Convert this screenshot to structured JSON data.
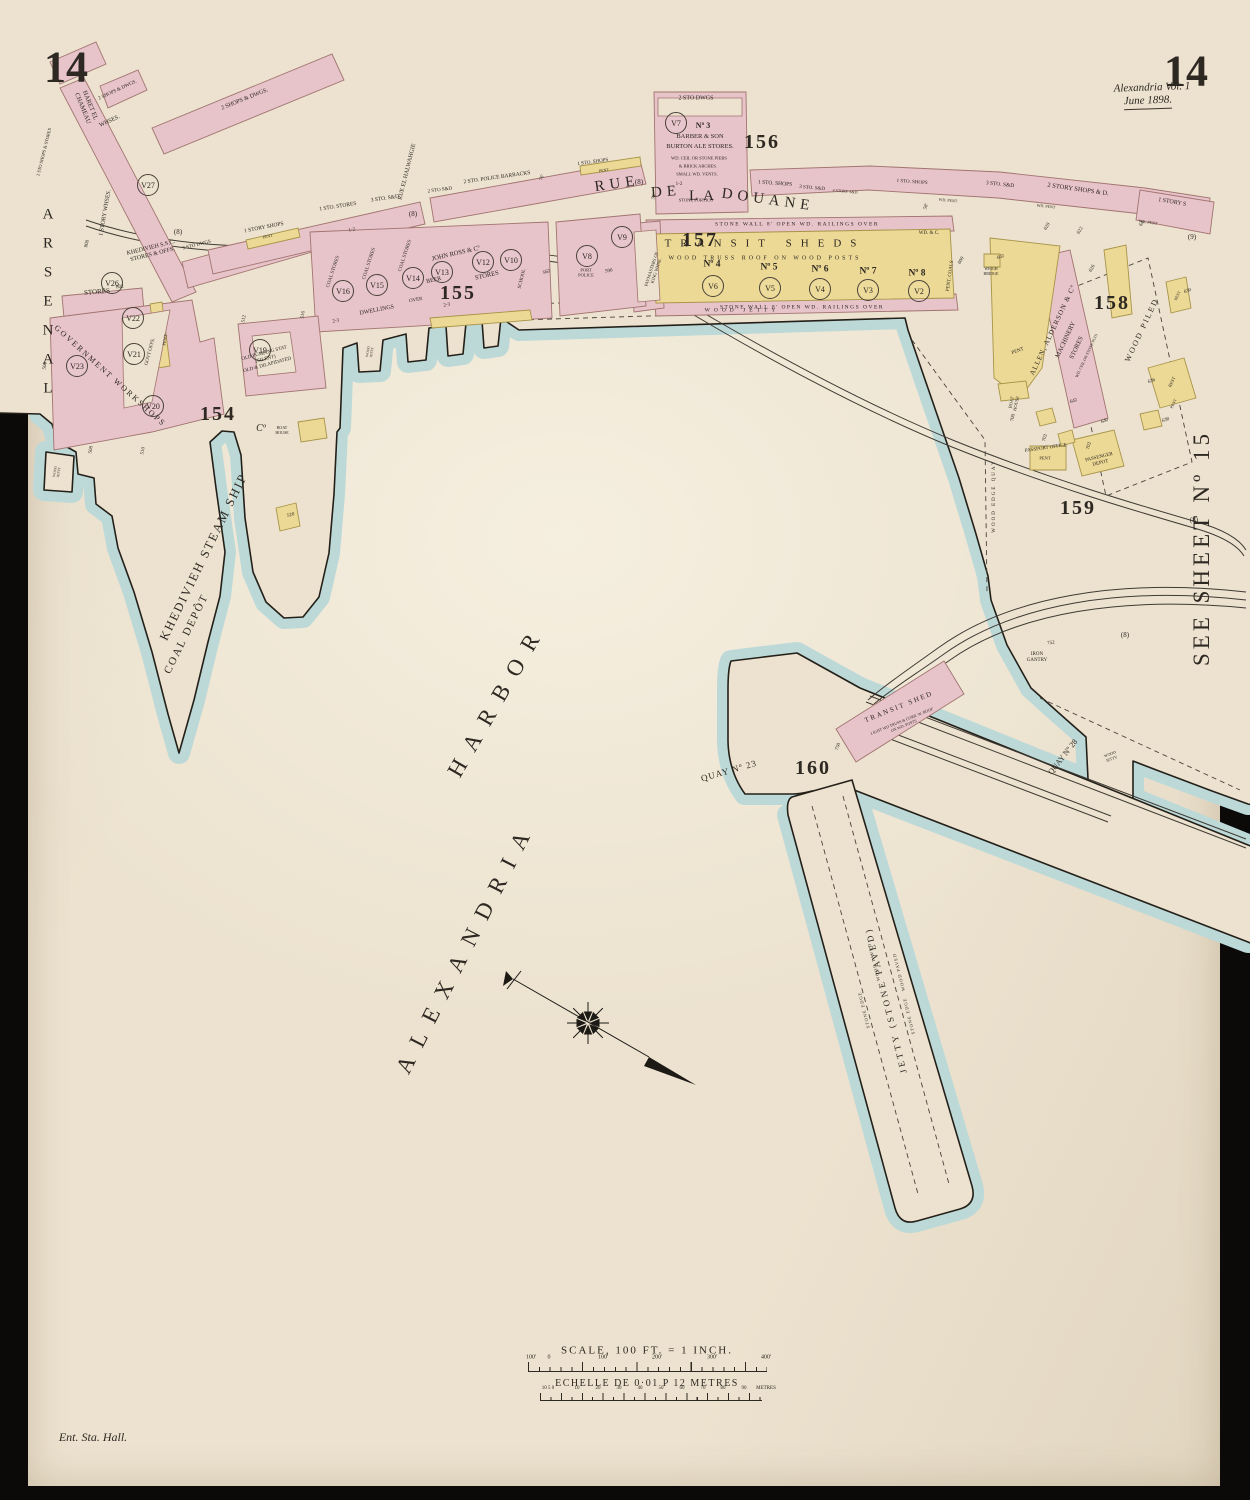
{
  "colors": {
    "paper": "#ece2cf",
    "water": "#bcd9d8",
    "building_pink": "#e7c3ca",
    "building_yellow": "#ecd995",
    "ink": "#2e2822",
    "frame": "#0b0a08"
  },
  "sheet": {
    "no_left": "14",
    "no_right": "14",
    "volume": "Alexandria Vol. 1",
    "date": "June 1898.",
    "see_sheet": "SEE SHEET Nº 15",
    "corner_note": "Ent. Sta. Hall."
  },
  "streets": {
    "rue": "RUE",
    "de": "DE",
    "la": "LA",
    "douane": "DOUANE",
    "haret": "HARET EL\nCHAMEAU",
    "halwahgie": "RUE EL HALWAHGIE",
    "arsenal": "ARSENAL"
  },
  "harbor": {
    "name1": "ALEXANDRIA",
    "name2": "HARBOR",
    "khedivieh": "KHEDIVIEH STEAM SHIP",
    "coal_depot": "COAL DEPÔT"
  },
  "blocks": {
    "b154": "154",
    "b155": "155",
    "b156": "156",
    "b157": "157",
    "b158": "158",
    "b159": "159",
    "b160": "160"
  },
  "v": {
    "v2": "V2",
    "v3": "V3",
    "v4": "V4",
    "v5": "V5",
    "v6": "V6",
    "v7": "V7",
    "v8": "V8",
    "v9": "V9",
    "v10": "V10",
    "v12": "V12",
    "v13": "V13",
    "v14": "V14",
    "v15": "V15",
    "v16": "V16",
    "v19": "V19",
    "v20": "V20",
    "v21": "V21",
    "v22": "V22",
    "v23": "V23",
    "v26": "V26",
    "v27": "V27"
  },
  "refs": {
    "r8": "(8)",
    "r9": "(9)"
  },
  "bldg": {
    "shops_dwgs": "2 SHOPS & DWGS.",
    "whses": "WHSES.",
    "story_whses": "1 STORY WHSES.",
    "sto_shops_stores": "2 STO SHOPS & STORES",
    "stores": "STORES",
    "khedivieh_ssc": "KHEDIVIEH S.S.C.\nSTORES & OFFS.",
    "sto_dwgs3": "3 STO DWGS",
    "story_shops": "1 STORY SHOPS",
    "sto_stores": "1 STO. STORES",
    "sto_sd3": "3 STO. S&D",
    "sto_sd2": "2 STO S&D",
    "police_barracks": "2 STO. POLICE BARRACKS",
    "sto_shops": "1 STO. SHOPS",
    "pent": "PENT",
    "sto_dwgs2": "2 STO DWGS",
    "no3": "Nº 3",
    "barber": "BARBER & SON",
    "burton": "BURTON ALE STORES.",
    "wd_ceil": "WD. CEIL OR STONE PIERS",
    "brick_arches": "& BRICK ARCHES.",
    "small_vents": "SMALL WD. VENTS.",
    "one_two": "1-2",
    "stone_portico": "STONE PORTICO",
    "sto_sd4": "4 STORY S&D",
    "story_shops_d2": "2 STORY SHOPS & D.",
    "story_s1": "1 STORY S",
    "wd_pent": "WD. PENT",
    "stone_wall": "STONE WALL 8' OPEN WD. RAILINGS OVER",
    "transit_sheds": "TRANSIT SHEDS",
    "wood_truss": "WOOD TRUSS ROOF ON WOOD POSTS",
    "shed4": "Nº 4",
    "shed5": "Nº 5",
    "shed6": "Nº 6",
    "shed7": "Nº 7",
    "shed8": "Nº 8",
    "wd_c": "WD. & C.",
    "pent_coals": "PENT. COALS",
    "paymasters": "PAYMASTERS OF\nKING WHSE.",
    "port_police": "PORT\nPOLICE",
    "gov_workshops": "GOVERNMENT WORKSHOPS",
    "govt_offs": "GOVT OFFS.",
    "old_pumping": "OLD PUMPING STAT\n(SILENT)\nOLD & DILAPIDATED",
    "co": "Cº",
    "boat_house": "BOAT\nHOUSE",
    "coal_stores": "COAL STORES",
    "john_ross": "JOHN ROSS & Cº",
    "beer": "BEER",
    "school": "SCHOOL",
    "dwellings": "DWELLINGS",
    "over": "OVER",
    "two_three": "2-3",
    "allen": "ALLEN, ALDERSON & Cº",
    "machinery": "MACHINERY",
    "wd_ceil2": "WD. CEIL OR STONE PLTS",
    "wood_piled": "WOOD PILED",
    "weigh_bridge": "WEIGH\nBRIDGE",
    "rest": "REST",
    "passport": "PASSPORT OFFICE",
    "passenger": "PASSENGER\nDEPOT",
    "wood_edge_quay": "WOOD EDGE QUAY",
    "iron_gantry": "IRON\nGANTRY",
    "transit_shed": "TRANSIT SHED",
    "light_truss": "LIGHT WD TRUSS & CORR. W. ROOF\nON WD. POSTS",
    "quay23": "QUAY Nº 23",
    "quay28": "QUAY Nº 28",
    "wood_jetty": "WOOD JETTY",
    "wood_jetty2": "WOOD\nJETTY",
    "jetty_main": "JETTY (STONE PAVED)",
    "stone_edge": "STONE EDGE",
    "wood_paved": "WOOD PAVED"
  },
  "nums": {
    "n58": "58'",
    "n64": "64'",
    "n76": "76'",
    "n500": "500",
    "n508": "508",
    "n510": "510",
    "n512": "512",
    "n516": "516",
    "n520": "520",
    "n562": "562",
    "n590": "590",
    "n600": "600",
    "n602": "602",
    "n620": "620",
    "n622": "622",
    "n626": "626",
    "n630": "630",
    "n636": "636",
    "n638": "638",
    "n640": "640",
    "n642": "642",
    "n700": "700",
    "n702": "702",
    "n750": "750",
    "n752": "752",
    "n800": "800",
    "n802": "802"
  },
  "scale": {
    "title": "SCALE, 100 FT. = 1 INCH.",
    "echelle": "ECHELLE DE 0·01 P 12 METRES",
    "feet": [
      "100'",
      "0",
      "100'",
      "200'",
      "300'",
      "400'"
    ],
    "metres_left": "10 5 0",
    "metres": [
      "10",
      "20",
      "30",
      "40",
      "50",
      "60",
      "70",
      "80",
      "90"
    ],
    "metres_unit": "METRES"
  }
}
